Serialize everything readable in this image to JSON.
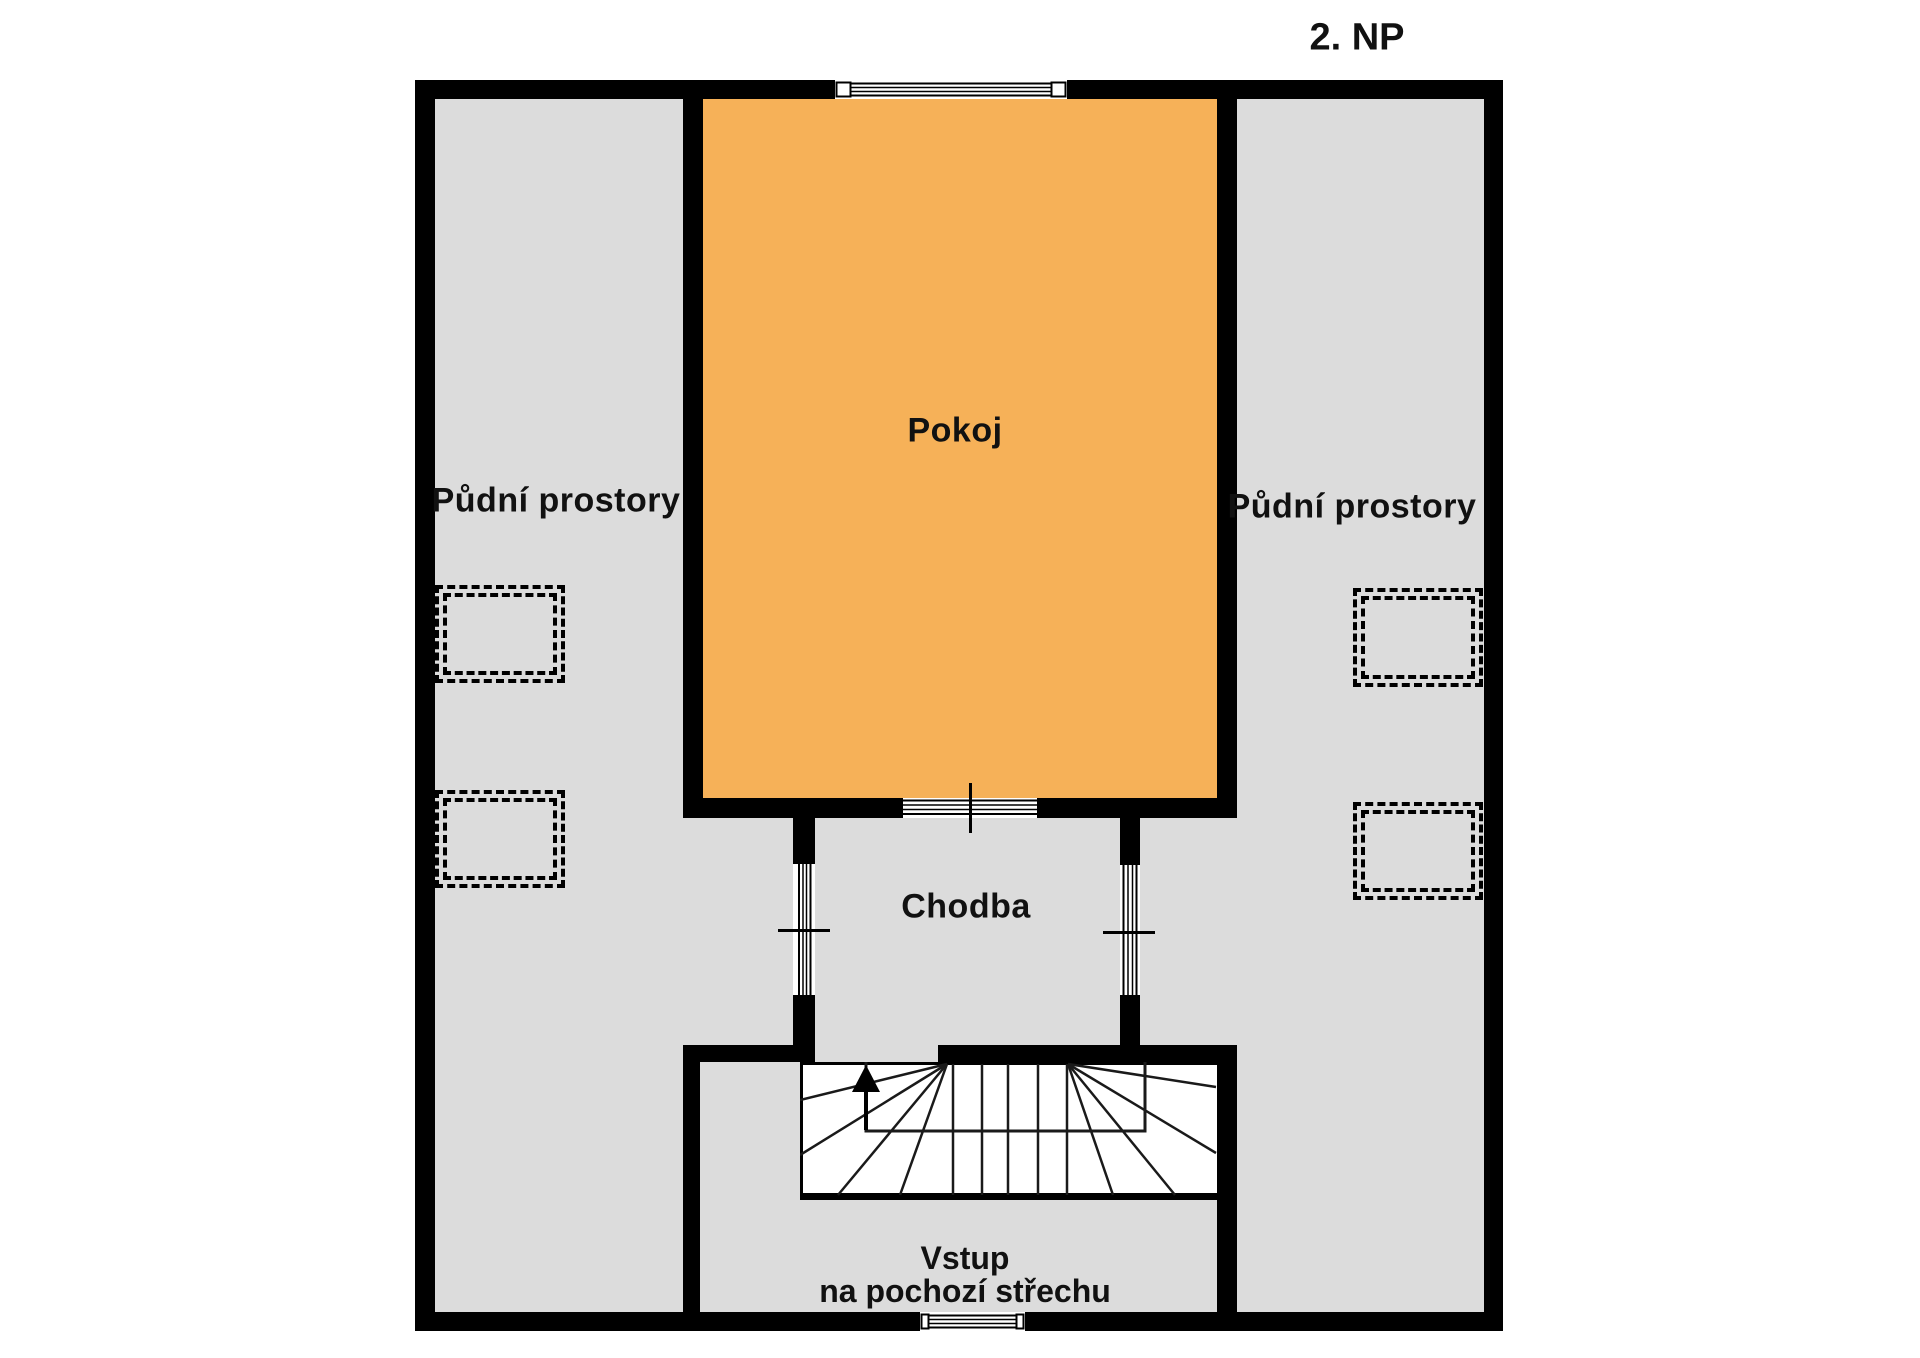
{
  "title": "2. NP",
  "colors": {
    "wall_black": "#000000",
    "attic_gray": "#DCDCDC",
    "room_orange": "#F6B158",
    "background": "#FFFFFF"
  },
  "rooms": {
    "attic_left": {
      "label": "Půdní prostory"
    },
    "attic_right": {
      "label": "Půdní prostory"
    },
    "pokoj": {
      "label": "Pokoj"
    },
    "chodba": {
      "label": "Chodba"
    },
    "vstup": {
      "line1": "Vstup",
      "line2": "na pochozí střechu"
    }
  },
  "stairs": {
    "direction": "up"
  }
}
